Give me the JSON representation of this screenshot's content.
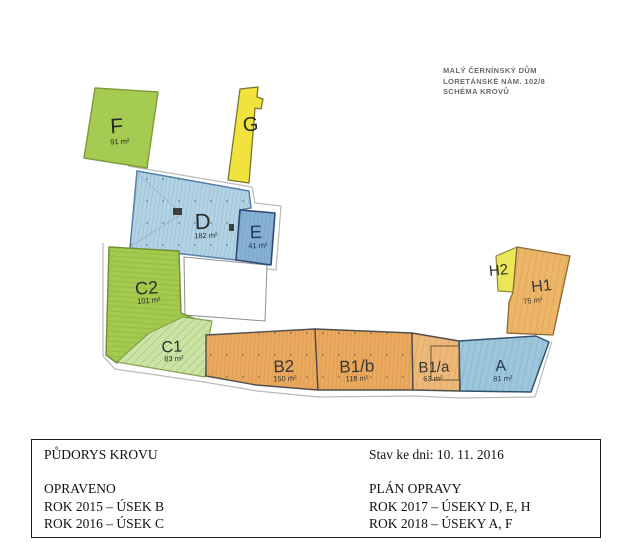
{
  "header": {
    "lines": [
      "MALÝ ČERNÍNSKÝ DŮM",
      "LORETÁNSKÉ NÁM. 102/8",
      "SCHÉMA KROVŮ"
    ],
    "color": "#6e6a64"
  },
  "plan": {
    "sections": [
      {
        "id": "F",
        "label": "F",
        "area": "91 m²",
        "fill": "#a6cb52",
        "label_color": "#262626"
      },
      {
        "id": "G",
        "label": "G",
        "area": "",
        "fill": "#f1e23e",
        "label_color": "#262626"
      },
      {
        "id": "D",
        "label": "D",
        "area": "182 m²",
        "fill": "#b1d3e4",
        "label_color": "#2b2b2b"
      },
      {
        "id": "E",
        "label": "E",
        "area": "41 m²",
        "fill": "#86b0d4",
        "label_color": "#1e3a63"
      },
      {
        "id": "C2",
        "label": "C2",
        "area": "101 m²",
        "fill": "#a3c94d",
        "label_color": "#2e2e2e"
      },
      {
        "id": "C1",
        "label": "C1",
        "area": "83 m²",
        "fill": "#cae4a5",
        "label_color": "#2e2e2e"
      },
      {
        "id": "B2",
        "label": "B2",
        "area": "150 m²",
        "fill": "#eba95e",
        "label_color": "#383838"
      },
      {
        "id": "B1b",
        "label": "B1/b",
        "area": "118 m²",
        "fill": "#eba95e",
        "label_color": "#383838"
      },
      {
        "id": "B1a",
        "label": "B1/a",
        "area": "63 m²",
        "fill": "#eeb878",
        "label_color": "#383838"
      },
      {
        "id": "A",
        "label": "A",
        "area": "81 m²",
        "fill": "#9cc6db",
        "label_color": "#26394d"
      },
      {
        "id": "H2",
        "label": "H2",
        "area": "",
        "fill": "#ebe658",
        "label_color": "#333333"
      },
      {
        "id": "H1",
        "label": "H1",
        "area": "75 m²",
        "fill": "#ecb567",
        "label_color": "#3a3a3a"
      }
    ]
  },
  "info_box": {
    "left_lines": [
      "PŮDORYS KROVU",
      "",
      "OPRAVENO",
      "ROK 2015 – ÚSEK B",
      "ROK 2016 – ÚSEK C"
    ],
    "right_lines": [
      "Stav ke dni: 10. 11. 2016",
      "",
      "PLÁN OPRAVY",
      "ROK 2017 – ÚSEKY D, E, H",
      "ROK 2018 – ÚSEKY A, F"
    ]
  }
}
